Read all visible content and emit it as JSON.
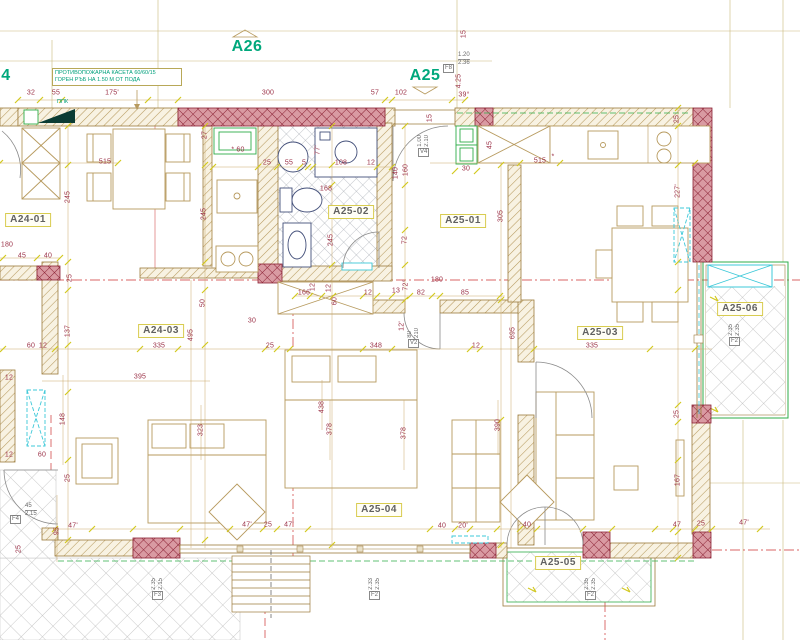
{
  "page": {
    "type": "architectural-floor-plan"
  },
  "colors": {
    "accent_teal": "#00A87C",
    "dimension_text": "#9B3147",
    "wall_line": "#9C7B3C",
    "concrete_hatch": "#8B2134",
    "window_green": "#2FAE4A",
    "fixture_cyan": "#3CC8D8",
    "tick_yellow": "#D2C81E",
    "label_border": "#D8CC50"
  },
  "apartment_labels": [
    {
      "text": "A26",
      "x": 247,
      "y": 47
    },
    {
      "text": "A25",
      "x": 425,
      "y": 76
    },
    {
      "text": "4",
      "x": 6,
      "y": 76
    }
  ],
  "room_labels": [
    {
      "text": "A24-01",
      "x": 28,
      "y": 220
    },
    {
      "text": "A24-03",
      "x": 161,
      "y": 331
    },
    {
      "text": "A25-01",
      "x": 463,
      "y": 221
    },
    {
      "text": "A25-02",
      "x": 351,
      "y": 212
    },
    {
      "text": "A25-03",
      "x": 600,
      "y": 333
    },
    {
      "text": "A25-04",
      "x": 379,
      "y": 510
    },
    {
      "text": "A25-05",
      "x": 558,
      "y": 563
    },
    {
      "text": "A25-06",
      "x": 740,
      "y": 309
    }
  ],
  "annotation": {
    "line1": "ПРОТИВОПОЖАРНА КАСЕТА  60/60/15",
    "line2": "ГОРЕН РЪБ НА 1.50 М ОТ ПОДА",
    "ppk": "ППК"
  },
  "tags": [
    {
      "label": "F8",
      "x": 443,
      "y": 56,
      "vals": [
        "1.20",
        "2.36"
      ],
      "dir": "right"
    },
    {
      "label": "V4",
      "x": 418,
      "y": 140,
      "vals": [
        "1.00",
        "2.10"
      ],
      "dir": "above"
    },
    {
      "label": "V2",
      "x": 408,
      "y": 331,
      "vals": [
        "80",
        "210"
      ],
      "dir": "above"
    },
    {
      "label": "F2",
      "x": 729,
      "y": 329,
      "vals": [
        "2.35",
        "2.35"
      ],
      "dir": "above"
    },
    {
      "label": "F2",
      "x": 369,
      "y": 583,
      "vals": [
        "2.33",
        "2.35"
      ],
      "dir": "above"
    },
    {
      "label": "F2",
      "x": 585,
      "y": 583,
      "vals": [
        "2.35",
        "2.35"
      ],
      "dir": "above"
    },
    {
      "label": "F3",
      "x": 152,
      "y": 583,
      "vals": [
        "2.35",
        "2.15"
      ],
      "dir": "above"
    },
    {
      "label": "F4",
      "x": 10,
      "y": 507,
      "vals": [
        "45",
        "2.15"
      ],
      "dir": "right"
    }
  ],
  "dims": [
    [
      "32",
      31,
      93
    ],
    [
      "55",
      56,
      93
    ],
    [
      "175'",
      112,
      93
    ],
    [
      "300",
      268,
      93
    ],
    [
      "57",
      375,
      93
    ],
    [
      "102",
      401,
      93
    ],
    [
      "4.25",
      459,
      81,
      1
    ],
    [
      "39°",
      464,
      95
    ],
    [
      "15",
      464,
      34,
      1
    ],
    [
      "15",
      430,
      118,
      1
    ],
    [
      "25",
      677,
      119,
      1
    ],
    [
      "* 60",
      238,
      150
    ],
    [
      "25",
      267,
      163
    ],
    [
      "55",
      289,
      163
    ],
    [
      "5",
      304,
      163
    ],
    [
      "77'",
      318,
      150,
      1
    ],
    [
      "108",
      341,
      163
    ],
    [
      "12",
      371,
      163
    ],
    [
      "140",
      396,
      173,
      1
    ],
    [
      "160",
      406,
      170,
      1
    ],
    [
      "30",
      466,
      169
    ],
    [
      "45",
      490,
      145,
      1
    ],
    [
      "515",
      105,
      162
    ],
    [
      "515",
      540,
      161
    ],
    [
      "27",
      205,
      135,
      1
    ],
    [
      "*",
      553,
      157
    ],
    [
      "245",
      68,
      197,
      1
    ],
    [
      "245",
      204,
      214,
      1
    ],
    [
      "227'",
      678,
      191,
      1
    ],
    [
      "168",
      326,
      189
    ],
    [
      "245",
      331,
      240,
      1
    ],
    [
      "72",
      405,
      240,
      1
    ],
    [
      "305",
      501,
      216,
      1
    ],
    [
      "180",
      7,
      245
    ],
    [
      "45",
      22,
      256
    ],
    [
      "40",
      48,
      256
    ],
    [
      "25",
      70,
      278,
      1
    ],
    [
      "166",
      304,
      293
    ],
    [
      "12",
      313,
      287,
      1
    ],
    [
      "12",
      329,
      288,
      1
    ],
    [
      "60",
      335,
      301,
      1
    ],
    [
      "12",
      368,
      293
    ],
    [
      "13",
      396,
      291
    ],
    [
      "72°",
      406,
      285,
      1
    ],
    [
      "82",
      421,
      293
    ],
    [
      "85",
      465,
      293
    ],
    [
      "180",
      437,
      280
    ],
    [
      "12'",
      402,
      326,
      1
    ],
    [
      "50",
      203,
      303,
      1
    ],
    [
      "30",
      252,
      321
    ],
    [
      "137",
      68,
      331,
      1
    ],
    [
      "495",
      191,
      335,
      1
    ],
    [
      "695",
      513,
      333,
      1
    ],
    [
      "60",
      31,
      346
    ],
    [
      "12",
      43,
      346
    ],
    [
      "335",
      159,
      346
    ],
    [
      "25",
      270,
      346
    ],
    [
      "348",
      376,
      346
    ],
    [
      "12",
      476,
      346
    ],
    [
      "335",
      592,
      346
    ],
    [
      "395",
      140,
      377
    ],
    [
      "12",
      9,
      378
    ],
    [
      "148",
      63,
      419,
      1
    ],
    [
      "60",
      42,
      455
    ],
    [
      "12",
      9,
      455
    ],
    [
      "323",
      201,
      430,
      1
    ],
    [
      "438",
      322,
      407,
      1
    ],
    [
      "378",
      330,
      429,
      1
    ],
    [
      "378",
      404,
      433,
      1
    ],
    [
      "390",
      498,
      425,
      1
    ],
    [
      "25",
      677,
      414,
      1
    ],
    [
      "167",
      678,
      480,
      1
    ],
    [
      "25",
      68,
      478,
      1
    ],
    [
      "95",
      57,
      531,
      1
    ],
    [
      "25",
      19,
      549,
      1
    ],
    [
      "47'",
      73,
      526
    ],
    [
      "47'",
      247,
      525
    ],
    [
      "25",
      268,
      525
    ],
    [
      "47'",
      289,
      525
    ],
    [
      "40",
      442,
      526
    ],
    [
      "20'",
      463,
      526
    ],
    [
      "40",
      527,
      525
    ],
    [
      "47",
      677,
      525
    ],
    [
      "25",
      701,
      524
    ],
    [
      "47'",
      744,
      523
    ]
  ]
}
